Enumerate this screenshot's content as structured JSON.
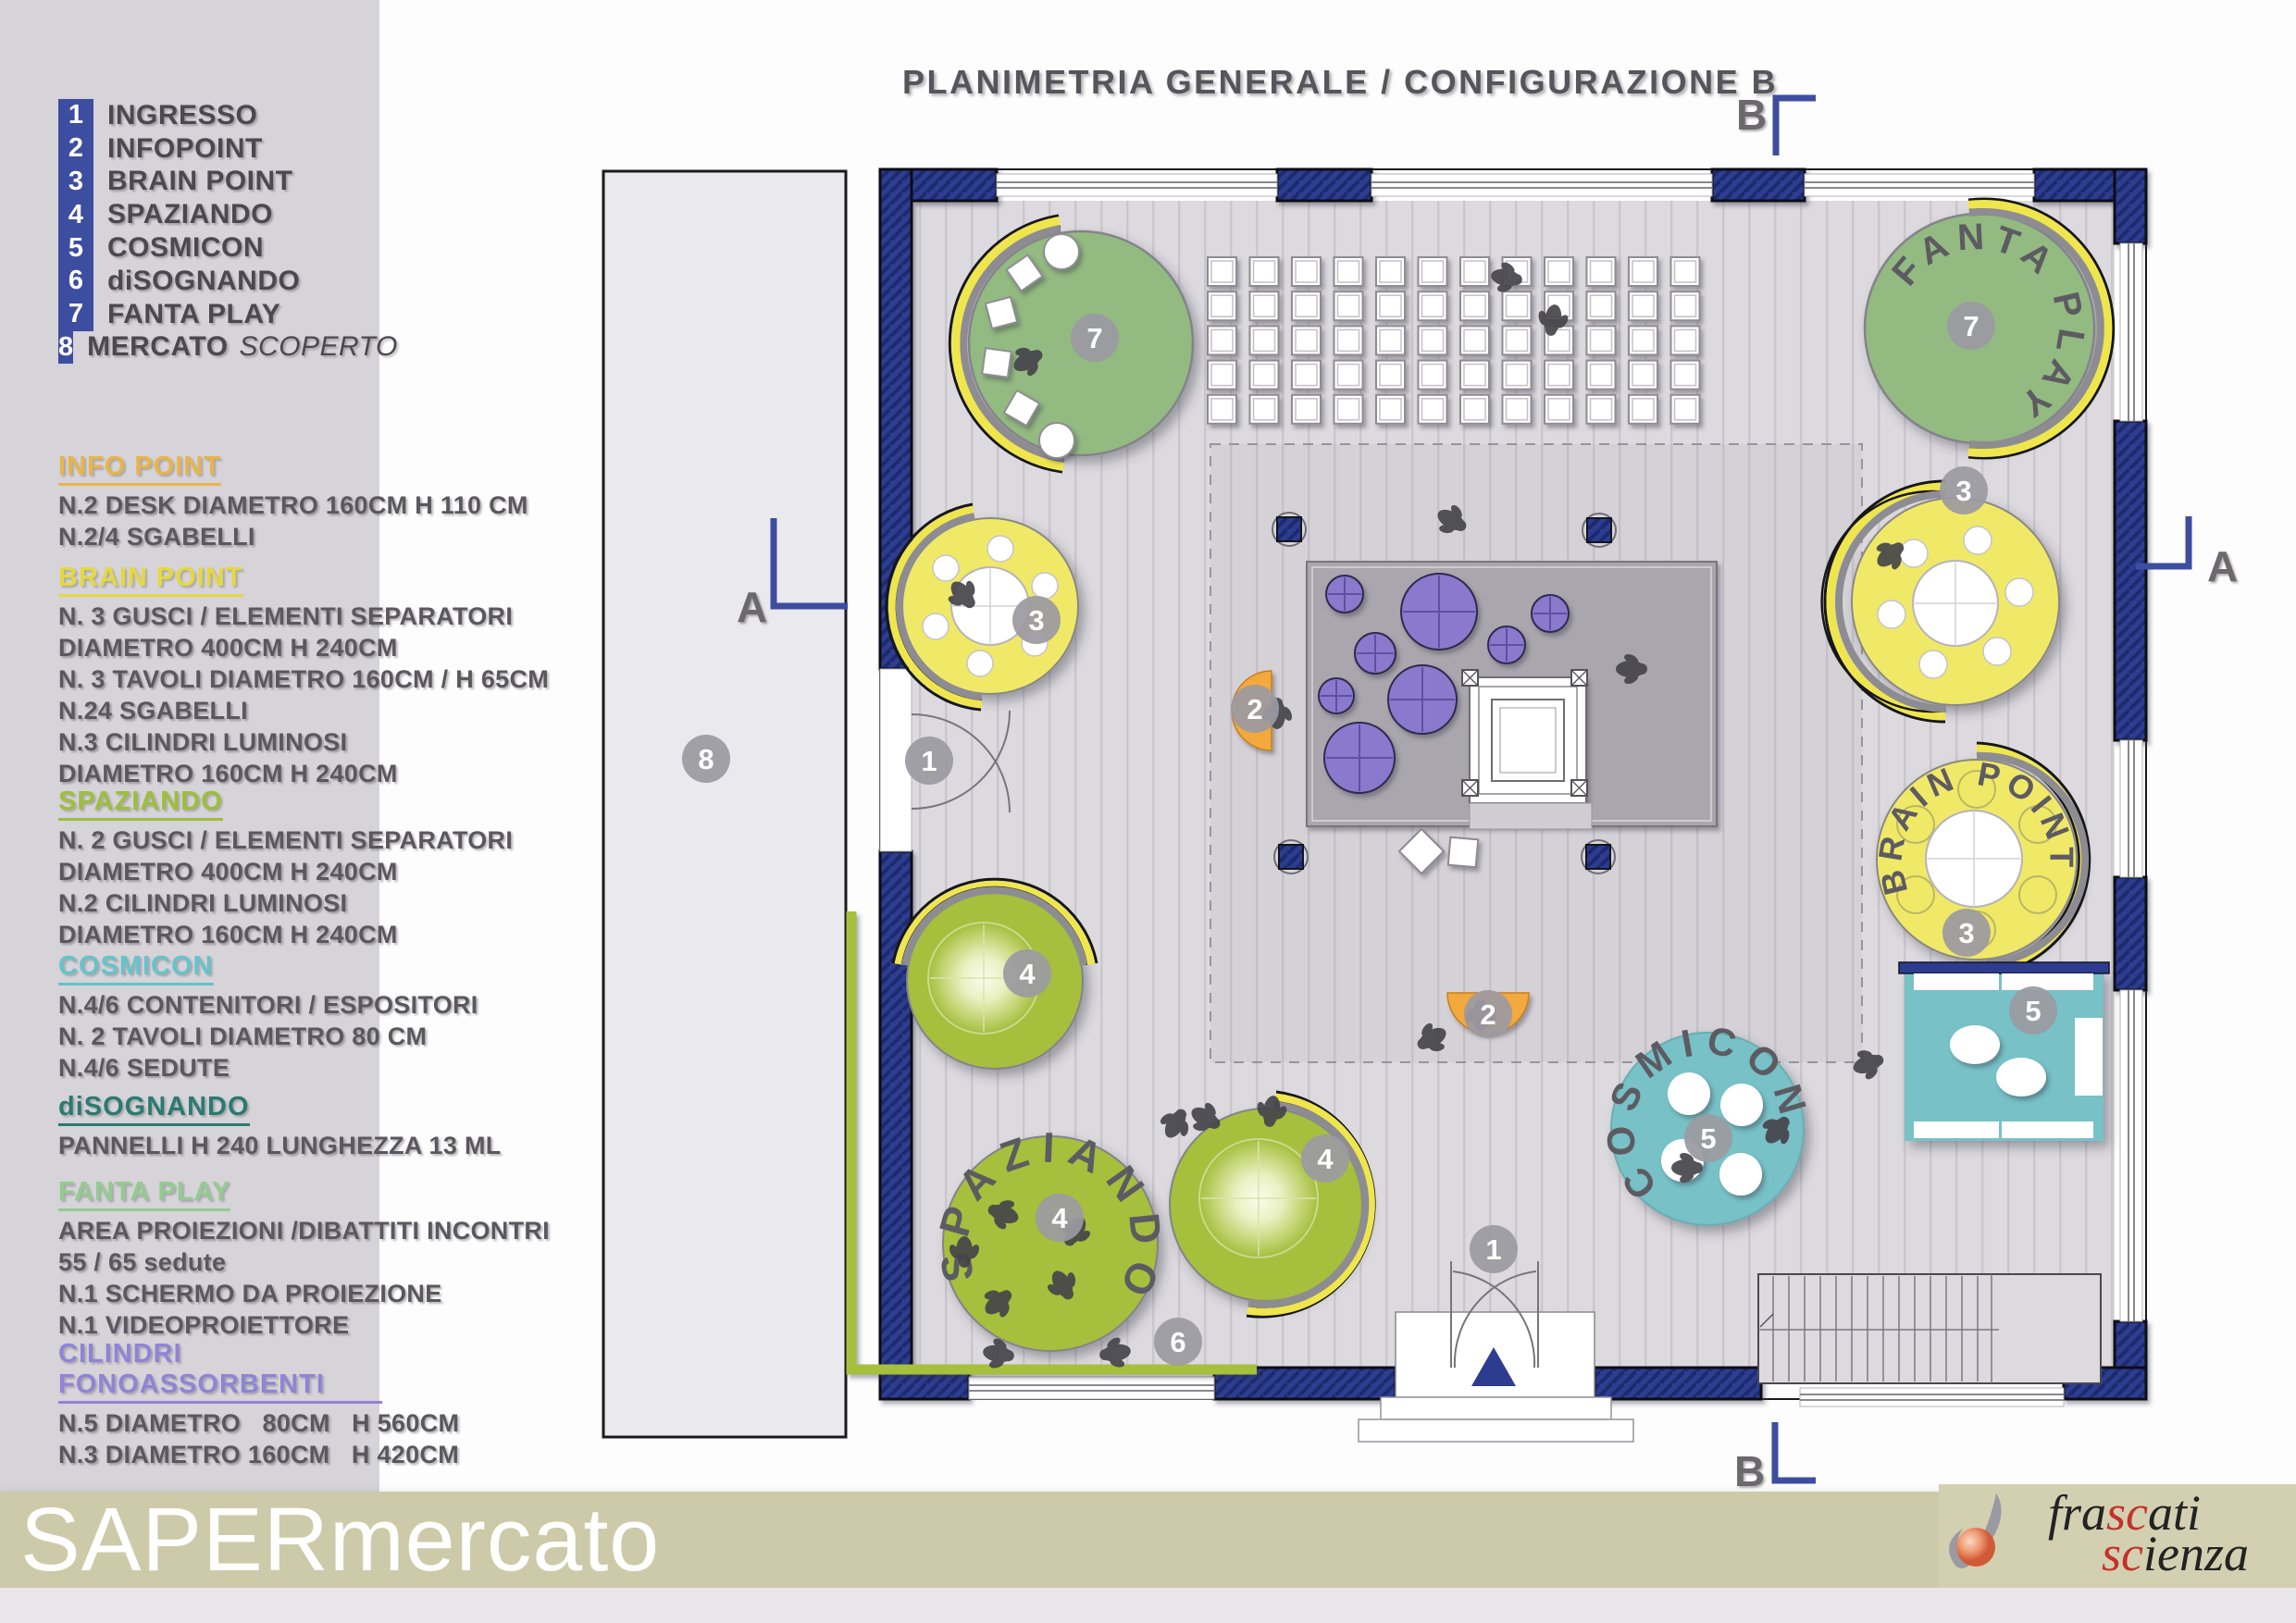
{
  "poster": {
    "title": "PLANIMETRIA GENERALE / CONFIGURAZIONE B"
  },
  "legend": {
    "items": [
      {
        "num": "1",
        "label": "INGRESSO"
      },
      {
        "num": "2",
        "label": "INFOPOINT"
      },
      {
        "num": "3",
        "label": "BRAIN POINT"
      },
      {
        "num": "4",
        "label": "SPAZIANDO"
      },
      {
        "num": "5",
        "label": "COSMICON"
      },
      {
        "num": "6",
        "label": "diSOGNANDO"
      },
      {
        "num": "7",
        "label": "FANTA PLAY"
      },
      {
        "num": "8",
        "label": "MERCATO",
        "label_suffix": "SCOPERTO"
      }
    ]
  },
  "sections": [
    {
      "title": "INFO POINT",
      "color": "#e7b54a",
      "lines": [
        "N.2 DESK DIAMETRO 160CM H 110 CM",
        "N.2/4 SGABELLI"
      ]
    },
    {
      "title": "BRAIN POINT",
      "color": "#e4d93f",
      "lines": [
        "N. 3 GUSCI / ELEMENTI SEPARATORI",
        "DIAMETRO 400CM H 240CM",
        "N. 3 TAVOLI DIAMETRO 160CM / H 65CM",
        "N.24 SGABELLI",
        "N.3 CILINDRI LUMINOSI",
        "DIAMETRO 160CM H 240CM"
      ]
    },
    {
      "title": "SPAZIANDO",
      "color": "#9cbf3b",
      "lines": [
        "N. 2 GUSCI / ELEMENTI SEPARATORI",
        "DIAMETRO 400CM H 240CM",
        "N.2 CILINDRI LUMINOSI",
        "DIAMETRO 160CM H 240CM"
      ]
    },
    {
      "title": "COSMICON",
      "color": "#66c3ca",
      "lines": [
        "N.4/6 CONTENITORI / ESPOSITORI",
        "N. 2 TAVOLI DIAMETRO 80 CM",
        "N.4/6 SEDUTE"
      ]
    },
    {
      "title": "diSOGNANDO",
      "color": "#2a7a70",
      "lines": [
        "PANNELLI H 240 LUNGHEZZA 13 ML"
      ]
    },
    {
      "title": "FANTA PLAY",
      "color": "#93cb90",
      "lines": [
        "AREA PROIEZIONI /DIBATTITI INCONTRI",
        "55 / 65 sedute",
        "N.1 SCHERMO DA PROIEZIONE",
        "N.1 VIDEOPROIETTORE"
      ]
    },
    {
      "title": "CILINDRI FONOASSORBENTI",
      "color": "#8f84d6",
      "lines": [
        "N.5 DIAMETRO   80CM   H 560CM",
        "N.3 DIAMETRO 160CM   H 420CM"
      ]
    }
  ],
  "plan": {
    "numbers": {
      "ingresso": "1",
      "infopoint": "2",
      "brain_point": "3",
      "spaziando": "4",
      "cosmicon": "5",
      "disognando": "6",
      "fanta_play": "7",
      "mercato": "8"
    },
    "area_labels": {
      "fanta_play": "FANTA PLAY",
      "brain_point": "BRAIN POINT",
      "spaziando": "SPAZIANDO",
      "cosmicon": "COSMICON"
    },
    "section_markers": {
      "a": "A",
      "b": "B"
    },
    "colors": {
      "wall": "#2d3c8f",
      "fanta_play_green": "#93ba81",
      "brain_point_yellow": "#f0e968",
      "spaziando_lime": "#a6bf3d",
      "cosmicon_teal": "#77c1c7",
      "infopoint_orange": "#f2a93c",
      "cilindri_purple": "#8a79cc",
      "accent_arc_yellow": "#efe64e"
    }
  },
  "footer": {
    "brand": "SAPERmercato",
    "logo": {
      "word1_parts": [
        "fra",
        "sc",
        "ati"
      ],
      "word2_parts": [
        "sc",
        "ienza"
      ],
      "accent_red": "#c3322b"
    }
  }
}
